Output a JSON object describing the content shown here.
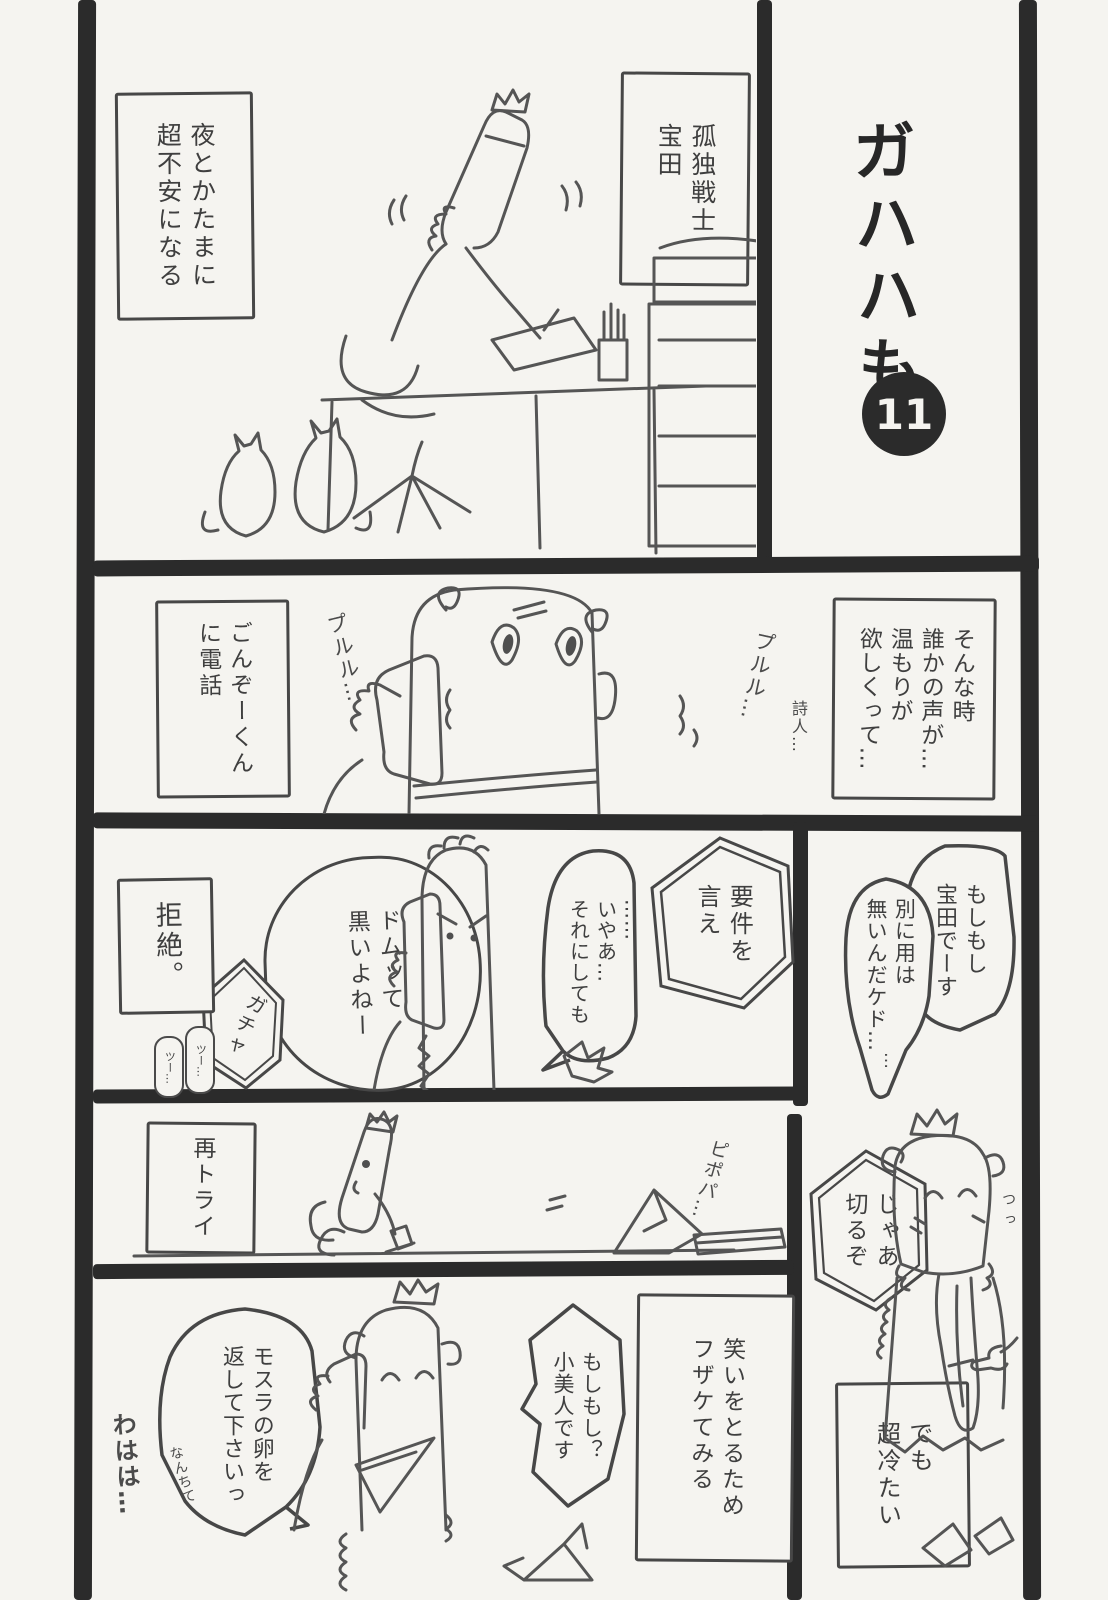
{
  "title": {
    "series": "ガハハも",
    "episode": "11"
  },
  "panel_intro": {
    "hero_label": "孤独戦士\n宝田",
    "anxiety_caption": "夜とかたまに\n超不安になる"
  },
  "panel_ring": {
    "narration": "そんな時\n誰かの声が…\n温もりが\n欲しくって…",
    "poet_aside": "詩人…",
    "call_caption": "ごんぞーくん\nに電話",
    "sfx_ring_left": "プルル…",
    "sfx_ring_right": "プルル…"
  },
  "panel_hello": {
    "greeting_bubble": "もしもし\n宝田でーす",
    "no_business_bubble": "別に用は\n無いんだケド…",
    "trailing_dots": "…"
  },
  "panel_reject": {
    "demand_bubble": "要件を\n言え",
    "well_bubble": "……\nいやあ…\nそれにしても",
    "dom_bubble": "ドムッて\n黒いよねー",
    "sfx_click": "ガチャ",
    "sfx_tone1": "ツー…",
    "sfx_tone2": "ツー…",
    "rejection_caption": "拒絶。"
  },
  "panel_retry": {
    "retry_caption": "再トライ",
    "sfx_dial": "ピポパ…"
  },
  "panel_hangup": {
    "hangup_bubble": "じゃあ\n切るぞ",
    "cold_caption": "でも\n超冷たい",
    "sfx_tsu": "つっ"
  },
  "panel_joke": {
    "joke_caption": "笑いをとるため\nフザケてみる",
    "shobijin_bubble": "もしもし？\n小美人です",
    "mothra_bubble": "モスラの卵を\n返して下さいっ",
    "nanchite_aside": "なんちて",
    "laugh_sfx": "わはは…"
  },
  "colors": {
    "paper": "#f5f4f0",
    "ink": "#2b2b2b",
    "line": "#555555",
    "text": "#3f3f3f"
  }
}
